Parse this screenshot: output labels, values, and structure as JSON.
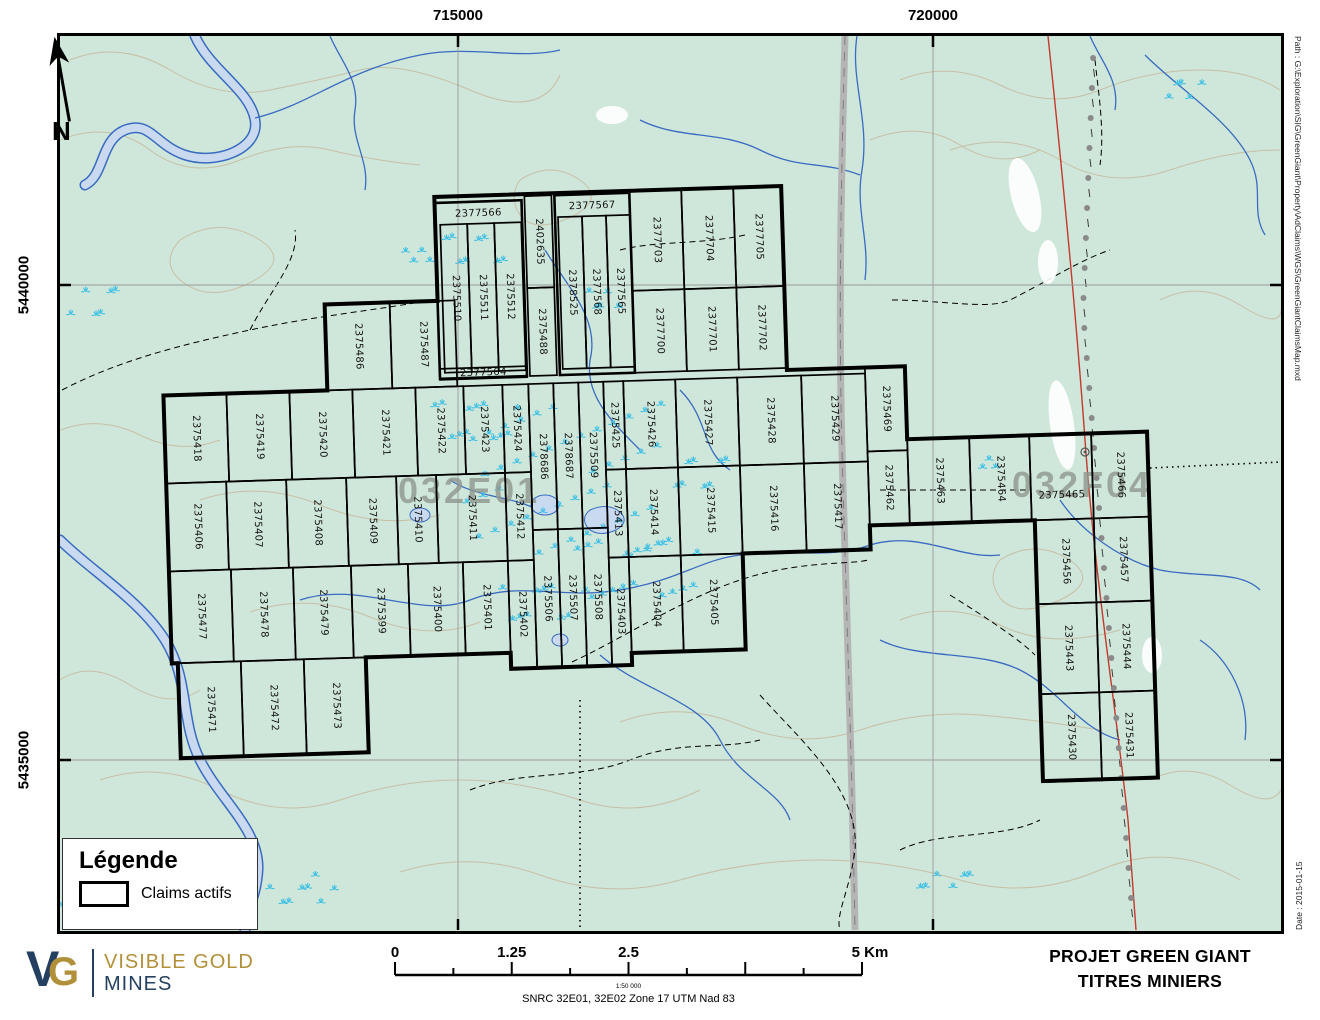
{
  "map": {
    "colors": {
      "map_bg": "#cfe7da",
      "marsh": "#3fc0e4",
      "water": "#3a6bc0",
      "water_fill": "#c9d9ef",
      "contour": "#c6bda2",
      "road": "#b5b5b5",
      "red_line": "#c2392e",
      "claim_outline": "#000000",
      "area_label": "#8f968f",
      "logo_navy": "#243f60",
      "logo_gold": "#b2903a"
    },
    "north_label": "N",
    "graticule": {
      "top": [
        {
          "label": "715000",
          "x": 458
        },
        {
          "label": "720000",
          "x": 933
        }
      ],
      "left": [
        {
          "label": "5440000",
          "y": 285
        },
        {
          "label": "5435000",
          "y": 760
        }
      ]
    },
    "area_labels": [
      {
        "text": "032E01",
        "x": 398,
        "y": 503,
        "size": 36
      },
      {
        "text": "032F04",
        "x": 1012,
        "y": 497,
        "size": 36
      }
    ],
    "legend": {
      "title": "Légende",
      "items": [
        {
          "label": "Claims actifs"
        }
      ]
    },
    "logo": {
      "v": "V",
      "g": "G",
      "line1": "VISIBLE GOLD",
      "line2": "MINES"
    },
    "scalebar": {
      "labels": [
        "0",
        "1.25",
        "2.5",
        "5 Km"
      ],
      "fractions": [
        0,
        0.25,
        0.5,
        1
      ],
      "ratio": "1:50 000",
      "datum": "SNRC 32E01, 32E02  Zone 17 UTM Nad 83"
    },
    "titleblock": {
      "line1": "PROJET GREEN GIANT",
      "line2": "TITRES MINIERS"
    },
    "margins": {
      "path_text": "Path : G:\\Exploration\\SIG\\GreenGiant\\Property\\AdClaims\\WGS\\GreenGiantClaimsMap.mxd",
      "date_text": "Date : 2015-01-15"
    },
    "marsh_clusters": [
      [
        478,
        255,
        70,
        45,
        8
      ],
      [
        600,
        300,
        40,
        30,
        5
      ],
      [
        95,
        300,
        55,
        45,
        6
      ],
      [
        70,
        898,
        30,
        18,
        4
      ],
      [
        300,
        888,
        70,
        28,
        8
      ],
      [
        565,
        480,
        200,
        160,
        46
      ],
      [
        480,
        425,
        90,
        60,
        12
      ],
      [
        640,
        565,
        130,
        85,
        18
      ],
      [
        950,
        878,
        60,
        24,
        6
      ],
      [
        1183,
        85,
        45,
        28,
        5
      ],
      [
        420,
        250,
        30,
        20,
        4
      ],
      [
        700,
        480,
        60,
        50,
        8
      ],
      [
        545,
        605,
        90,
        55,
        10
      ],
      [
        985,
        462,
        24,
        16,
        3
      ]
    ],
    "claims": [
      {
        "n": "2377566",
        "x": 443,
        "y": 196,
        "w": 87,
        "h": 176,
        "o": "h",
        "ly": 208,
        "t": 1
      },
      {
        "n": "2375510",
        "x": 448,
        "y": 218,
        "w": 27,
        "h": 148,
        "o": "v"
      },
      {
        "n": "2375511",
        "x": 475,
        "y": 218,
        "w": 27,
        "h": 148,
        "o": "v"
      },
      {
        "n": "2375512",
        "x": 502,
        "y": 218,
        "w": 27,
        "h": 148,
        "o": "v"
      },
      {
        "n": "2402635",
        "x": 533,
        "y": 192,
        "w": 27,
        "h": 92,
        "o": "v"
      },
      {
        "n": "2375488",
        "x": 533,
        "y": 284,
        "w": 27,
        "h": 88,
        "o": "v"
      },
      {
        "n": "2377567",
        "x": 563,
        "y": 192,
        "w": 75,
        "h": 180,
        "o": "h",
        "ly": 204,
        "t": 1
      },
      {
        "n": "2378525",
        "x": 566,
        "y": 214,
        "w": 24,
        "h": 152,
        "o": "v"
      },
      {
        "n": "2377568",
        "x": 590,
        "y": 214,
        "w": 24,
        "h": 152,
        "o": "v"
      },
      {
        "n": "2377565",
        "x": 614,
        "y": 214,
        "w": 24,
        "h": 152,
        "o": "v"
      },
      {
        "n": "2377564",
        "x": 443,
        "y": 362,
        "w": 87,
        "h": 11,
        "o": "h",
        "fs": 9
      },
      {
        "n": "2377703",
        "x": 638,
        "y": 190,
        "w": 52,
        "h": 100,
        "o": "v"
      },
      {
        "n": "2377704",
        "x": 690,
        "y": 190,
        "w": 52,
        "h": 100,
        "o": "v"
      },
      {
        "n": "2377705",
        "x": 742,
        "y": 190,
        "w": 48,
        "h": 100,
        "o": "v"
      },
      {
        "n": "2377700",
        "x": 638,
        "y": 290,
        "w": 52,
        "h": 82,
        "o": "v"
      },
      {
        "n": "2377701",
        "x": 690,
        "y": 290,
        "w": 52,
        "h": 82,
        "o": "v"
      },
      {
        "n": "2377702",
        "x": 742,
        "y": 290,
        "w": 48,
        "h": 82,
        "o": "v"
      },
      {
        "n": "2375486",
        "x": 330,
        "y": 294,
        "w": 65,
        "h": 86,
        "o": "v"
      },
      {
        "n": "2375487",
        "x": 395,
        "y": 294,
        "w": 65,
        "h": 86,
        "o": "v"
      },
      {
        "n": "2375418",
        "x": 166,
        "y": 380,
        "w": 63,
        "h": 88,
        "o": "v"
      },
      {
        "n": "2375419",
        "x": 229,
        "y": 380,
        "w": 63,
        "h": 88,
        "o": "v"
      },
      {
        "n": "2375420",
        "x": 292,
        "y": 380,
        "w": 63,
        "h": 88,
        "o": "v"
      },
      {
        "n": "2375421",
        "x": 355,
        "y": 380,
        "w": 63,
        "h": 88,
        "o": "v"
      },
      {
        "n": "2375422",
        "x": 418,
        "y": 380,
        "w": 48,
        "h": 88,
        "o": "v"
      },
      {
        "n": "2375423",
        "x": 466,
        "y": 380,
        "w": 39,
        "h": 88,
        "o": "v"
      },
      {
        "n": "2375424",
        "x": 505,
        "y": 380,
        "w": 26,
        "h": 88,
        "o": "v"
      },
      {
        "n": "2378686",
        "x": 531,
        "y": 380,
        "w": 25,
        "h": 146,
        "o": "v"
      },
      {
        "n": "2378687",
        "x": 556,
        "y": 380,
        "w": 25,
        "h": 146,
        "o": "v"
      },
      {
        "n": "2375509",
        "x": 581,
        "y": 380,
        "w": 25,
        "h": 146,
        "o": "v"
      },
      {
        "n": "2375425",
        "x": 606,
        "y": 380,
        "w": 20,
        "h": 88,
        "o": "v"
      },
      {
        "n": "2375426",
        "x": 626,
        "y": 380,
        "w": 52,
        "h": 88,
        "o": "v"
      },
      {
        "n": "2375427",
        "x": 678,
        "y": 380,
        "w": 62,
        "h": 88,
        "o": "v"
      },
      {
        "n": "2375428",
        "x": 740,
        "y": 380,
        "w": 64,
        "h": 88,
        "o": "v"
      },
      {
        "n": "2375429",
        "x": 804,
        "y": 380,
        "w": 64,
        "h": 88,
        "o": "v"
      },
      {
        "n": "2375469",
        "x": 868,
        "y": 374,
        "w": 40,
        "h": 84,
        "o": "v"
      },
      {
        "n": "2375406",
        "x": 166,
        "y": 468,
        "w": 60,
        "h": 88,
        "o": "v"
      },
      {
        "n": "2375407",
        "x": 226,
        "y": 468,
        "w": 60,
        "h": 88,
        "o": "v"
      },
      {
        "n": "2375408",
        "x": 286,
        "y": 468,
        "w": 60,
        "h": 88,
        "o": "v"
      },
      {
        "n": "2375409",
        "x": 346,
        "y": 468,
        "w": 50,
        "h": 88,
        "o": "v"
      },
      {
        "n": "2375410",
        "x": 396,
        "y": 468,
        "w": 40,
        "h": 88,
        "o": "v"
      },
      {
        "n": "2375411",
        "x": 436,
        "y": 468,
        "w": 69,
        "h": 88,
        "o": "v"
      },
      {
        "n": "2375412",
        "x": 505,
        "y": 468,
        "w": 26,
        "h": 88,
        "o": "v"
      },
      {
        "n": "2375413",
        "x": 606,
        "y": 468,
        "w": 20,
        "h": 88,
        "o": "v"
      },
      {
        "n": "2375414",
        "x": 626,
        "y": 468,
        "w": 52,
        "h": 88,
        "o": "v"
      },
      {
        "n": "2375415",
        "x": 678,
        "y": 468,
        "w": 62,
        "h": 88,
        "o": "v"
      },
      {
        "n": "2375416",
        "x": 740,
        "y": 468,
        "w": 64,
        "h": 88,
        "o": "v"
      },
      {
        "n": "2375417",
        "x": 804,
        "y": 468,
        "w": 64,
        "h": 88,
        "o": "v"
      },
      {
        "n": "2375462",
        "x": 868,
        "y": 458,
        "w": 40,
        "h": 74,
        "o": "v"
      },
      {
        "n": "2375506",
        "x": 531,
        "y": 526,
        "w": 25,
        "h": 138,
        "o": "v"
      },
      {
        "n": "2375507",
        "x": 556,
        "y": 526,
        "w": 25,
        "h": 138,
        "o": "v"
      },
      {
        "n": "2375508",
        "x": 581,
        "y": 526,
        "w": 25,
        "h": 138,
        "o": "v"
      },
      {
        "n": "2375477",
        "x": 166,
        "y": 556,
        "w": 62,
        "h": 92,
        "o": "v"
      },
      {
        "n": "2375478",
        "x": 228,
        "y": 556,
        "w": 62,
        "h": 92,
        "o": "v"
      },
      {
        "n": "2375479",
        "x": 290,
        "y": 556,
        "w": 58,
        "h": 92,
        "o": "v"
      },
      {
        "n": "2375399",
        "x": 348,
        "y": 556,
        "w": 57,
        "h": 92,
        "o": "v"
      },
      {
        "n": "2375400",
        "x": 405,
        "y": 556,
        "w": 55,
        "h": 92,
        "o": "v"
      },
      {
        "n": "2375401",
        "x": 460,
        "y": 556,
        "w": 45,
        "h": 92,
        "o": "v"
      },
      {
        "n": "2375402",
        "x": 505,
        "y": 556,
        "w": 26,
        "h": 108,
        "o": "v"
      },
      {
        "n": "2375403",
        "x": 606,
        "y": 556,
        "w": 20,
        "h": 108,
        "o": "v"
      },
      {
        "n": "2375404",
        "x": 626,
        "y": 556,
        "w": 52,
        "h": 96,
        "o": "v"
      },
      {
        "n": "2375405",
        "x": 678,
        "y": 556,
        "w": 62,
        "h": 96,
        "o": "v"
      },
      {
        "n": "2375471",
        "x": 172,
        "y": 648,
        "w": 63,
        "h": 95,
        "o": "v"
      },
      {
        "n": "2375472",
        "x": 235,
        "y": 648,
        "w": 63,
        "h": 95,
        "o": "v"
      },
      {
        "n": "2375473",
        "x": 298,
        "y": 648,
        "w": 62,
        "h": 95,
        "o": "v"
      },
      {
        "n": "2375463",
        "x": 908,
        "y": 447,
        "w": 62,
        "h": 85,
        "o": "v"
      },
      {
        "n": "2375464",
        "x": 970,
        "y": 447,
        "w": 60,
        "h": 85,
        "o": "v"
      },
      {
        "n": "2375465",
        "x": 1030,
        "y": 447,
        "w": 62,
        "h": 85,
        "o": "h",
        "ly": 508
      },
      {
        "n": "2375466",
        "x": 1092,
        "y": 447,
        "w": 56,
        "h": 85,
        "o": "v"
      },
      {
        "n": "2375456",
        "x": 1033,
        "y": 532,
        "w": 59,
        "h": 84,
        "o": "v"
      },
      {
        "n": "2375457",
        "x": 1092,
        "y": 532,
        "w": 56,
        "h": 84,
        "o": "v"
      },
      {
        "n": "2375443",
        "x": 1033,
        "y": 616,
        "w": 59,
        "h": 90,
        "o": "v"
      },
      {
        "n": "2375444",
        "x": 1092,
        "y": 616,
        "w": 56,
        "h": 90,
        "o": "v"
      },
      {
        "n": "2375430",
        "x": 1033,
        "y": 706,
        "w": 59,
        "h": 88,
        "o": "v"
      },
      {
        "n": "2375431",
        "x": 1092,
        "y": 706,
        "w": 56,
        "h": 88,
        "o": "v"
      }
    ]
  }
}
